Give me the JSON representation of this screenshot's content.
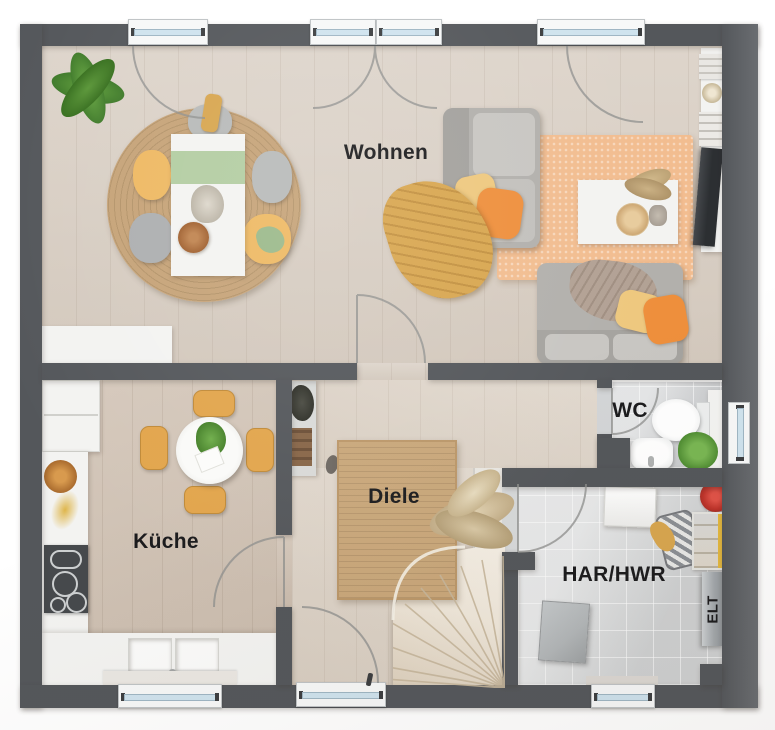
{
  "rooms": {
    "wohnen": {
      "label": "Wohnen"
    },
    "kueche": {
      "label": "Küche"
    },
    "diele": {
      "label": "Diele"
    },
    "wc": {
      "label": "WC"
    },
    "har": {
      "label": "HAR/HWR"
    },
    "elt": {
      "label": "ELT"
    }
  },
  "colors": {
    "wall": "#54575b",
    "wood_living": "#d9cfc4",
    "wood_kitchen": "#d1c3b5",
    "wood_diele": "#ddd3c7",
    "tile_wc": "#d3d5d7",
    "tile_har": "#d7d9da",
    "furniture_white": "#f3f3f1",
    "rug_jute": "#c6a378",
    "rug_living": "#f2bd90",
    "rug_diele": "#c9a77a",
    "sofa_gray": "#b2b0ac",
    "sofa_light": "#c8c6c2",
    "accent_orange": "#ee8f3c",
    "accent_yellow": "#eec87e",
    "accent_mustard": "#d8a64f",
    "chair_yellow": "#e2a54c",
    "plant_green": "#69a243",
    "runner_sage": "#b3cda2",
    "tv_dark": "#2c2f32",
    "glass_blue": "#cfe3ee",
    "stair_bg": "#efe7da",
    "appliance_gray": "#b2b6b8",
    "label_text": "#1b1b1d"
  }
}
